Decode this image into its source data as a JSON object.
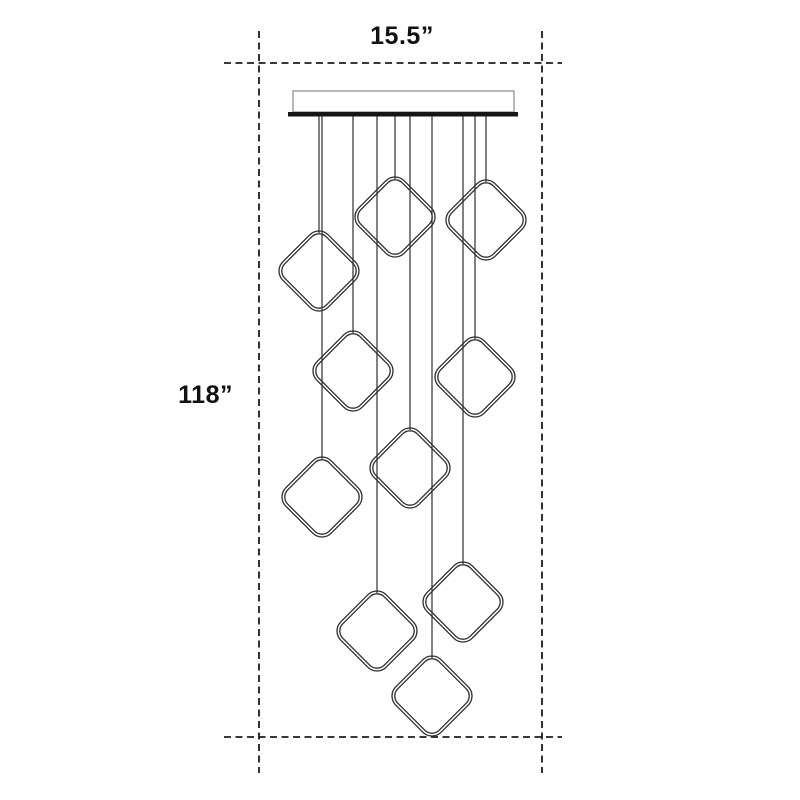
{
  "diagram": {
    "title": "pendant-light-dimension-drawing",
    "width_label": "15.5”",
    "height_label": "118”",
    "background": "#ffffff",
    "line_color": "#2e2e2e",
    "dash_color": "#1c1c1c",
    "text_color": "#111111",
    "guides": {
      "vertical_lines_x": [
        259,
        542
      ],
      "vertical_extent": [
        31,
        773
      ],
      "horizontal_lines_y": [
        63,
        737
      ],
      "horizontal_extent": [
        224,
        562
      ],
      "dash_pattern": "7 4.5",
      "stroke_width": 1.8
    },
    "canopy": {
      "x": 293,
      "y": 91,
      "width": 221,
      "height": 21,
      "border_color": "#888888",
      "plate_x": 288,
      "plate_y": 112,
      "plate_width": 230,
      "plate_height": 4.5,
      "plate_color": "#151515"
    },
    "wire_top_y": 116,
    "wire_stroke_width": 1.2,
    "pendant_style": {
      "half_diagonal": 40,
      "corner_radius": 13,
      "outline_gap": 2.8,
      "stroke_width": 1.3,
      "rotation_deg": 45
    },
    "pendants": [
      {
        "cx": 395,
        "cy": 217
      },
      {
        "cx": 486,
        "cy": 220
      },
      {
        "cx": 319,
        "cy": 271
      },
      {
        "cx": 353,
        "cy": 371
      },
      {
        "cx": 475,
        "cy": 377
      },
      {
        "cx": 322,
        "cy": 497
      },
      {
        "cx": 410,
        "cy": 468
      },
      {
        "cx": 377,
        "cy": 631
      },
      {
        "cx": 463,
        "cy": 602
      },
      {
        "cx": 432,
        "cy": 696
      }
    ]
  }
}
